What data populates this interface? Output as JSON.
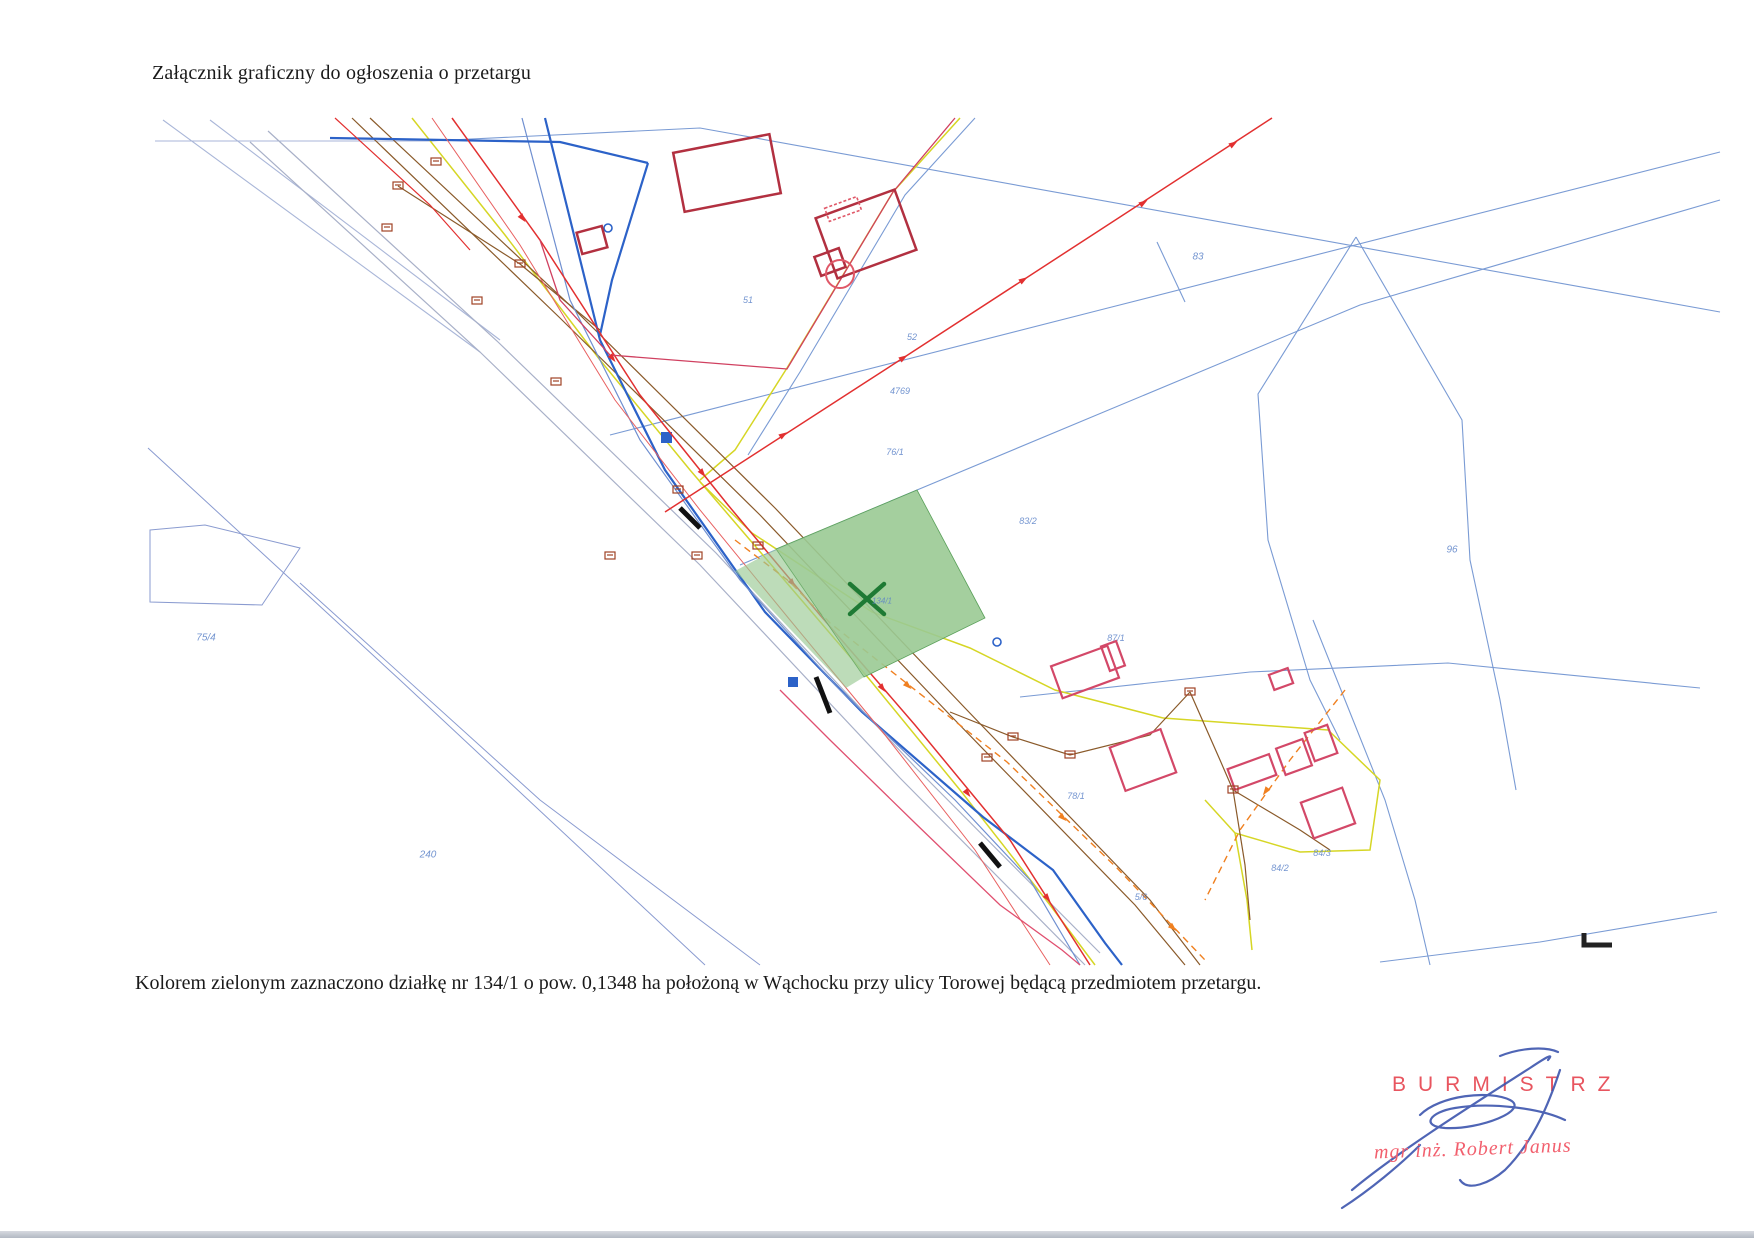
{
  "page": {
    "title": "Załącznik graficzny do ogłoszenia o przetargu",
    "caption": "Kolorem zielonym zaznaczono działkę nr 134/1 o pow. 0,1348 ha położoną w Wąchocku przy ulicy Torowej będącą przedmiotem przetargu."
  },
  "signature": {
    "office": "BURMISTRZ",
    "name": "mgr inż. Robert Janus"
  },
  "map": {
    "highlighted_parcel": {
      "number": "134/1",
      "area_ha": "0,1348",
      "street": "ul. Torowa, Wąchock"
    },
    "colors": {
      "parcel_highlight": "#9aca94",
      "parcel_boundary": "#7a9bd4",
      "power_line": "#e23030",
      "gas_line": "#d8d820",
      "water_line": "#2c62c8",
      "telecom_line": "#8a5a2a",
      "building_outline": "#b23040",
      "signature_ink": "#3c55ae",
      "stamp_text": "#e8555f"
    },
    "parcel_labels": [
      {
        "text": "83",
        "x": 1198,
        "y": 257,
        "size": 10
      },
      {
        "text": "52",
        "x": 912,
        "y": 337,
        "size": 9
      },
      {
        "text": "4769",
        "x": 900,
        "y": 391,
        "size": 9
      },
      {
        "text": "76/1",
        "x": 895,
        "y": 452,
        "size": 9
      },
      {
        "text": "83/2",
        "x": 1028,
        "y": 521,
        "size": 9
      },
      {
        "text": "96",
        "x": 1452,
        "y": 550,
        "size": 10
      },
      {
        "text": "75/4",
        "x": 206,
        "y": 638,
        "size": 10
      },
      {
        "text": "240",
        "x": 428,
        "y": 855,
        "size": 10
      },
      {
        "text": "78/1",
        "x": 1076,
        "y": 796,
        "size": 9
      },
      {
        "text": "87/1",
        "x": 1116,
        "y": 638,
        "size": 9
      },
      {
        "text": "84/3",
        "x": 1322,
        "y": 853,
        "size": 9
      },
      {
        "text": "84/2",
        "x": 1280,
        "y": 868,
        "size": 9
      },
      {
        "text": "5/6",
        "x": 1141,
        "y": 897,
        "size": 9
      },
      {
        "text": "51",
        "x": 748,
        "y": 300,
        "size": 9
      },
      {
        "text": "134/1",
        "x": 882,
        "y": 601,
        "size": 8
      }
    ]
  }
}
